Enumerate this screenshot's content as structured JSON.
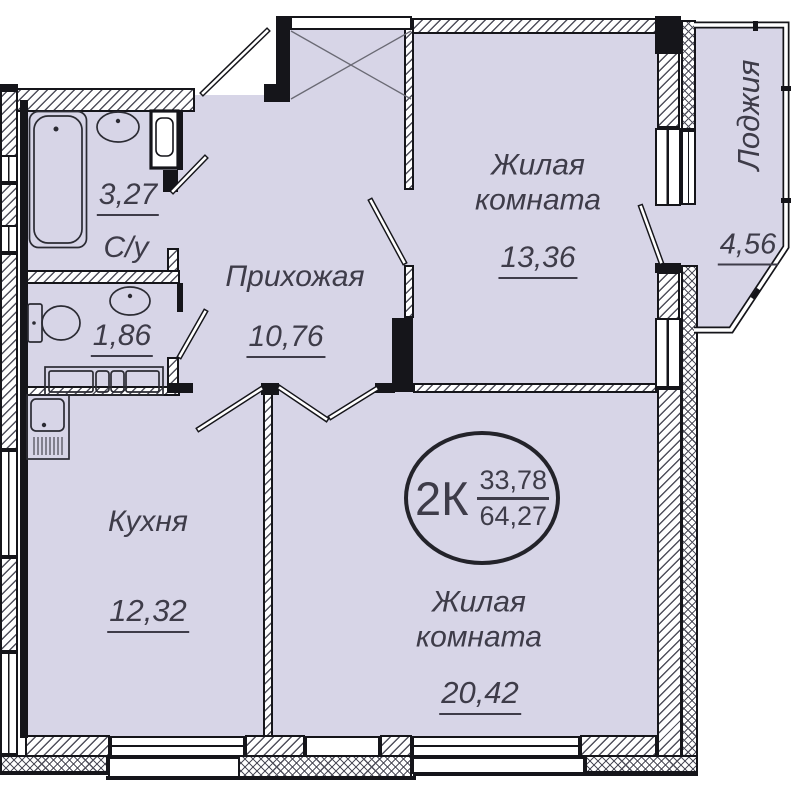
{
  "plan": {
    "badge": {
      "type": "2К",
      "upper_area": "33,78",
      "lower_area": "64,27"
    },
    "rooms": {
      "bathroom": {
        "name": "С/у",
        "area": "3,27"
      },
      "toilet": {
        "area": "1,86"
      },
      "hallway": {
        "name": "Прихожая",
        "area": "10,76"
      },
      "living1": {
        "name": "Жилая комната",
        "area": "13,36"
      },
      "kitchen": {
        "name": "Кухня",
        "area": "12,32"
      },
      "living2": {
        "name": "Жилая комната",
        "area": "20,42"
      },
      "loggia": {
        "name": "Лоджия",
        "area": "4,56"
      }
    },
    "colors": {
      "floor": "#d7d5e7",
      "wall": "#15151a",
      "text": "#3e3c49",
      "hatch": "#50505c"
    }
  }
}
